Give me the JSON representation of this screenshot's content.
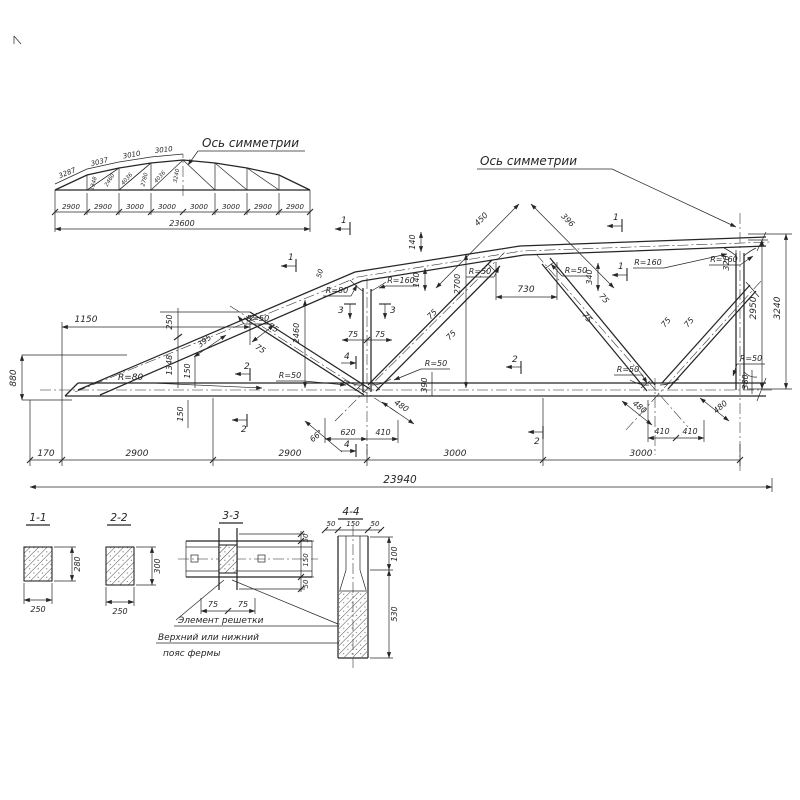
{
  "colors": {
    "ink": "#262626",
    "paper": "#ffffff"
  },
  "overview": {
    "axis_label": "Ось симметрии",
    "top_chord_dims": [
      "3287",
      "3037",
      "3010",
      "3010"
    ],
    "web_dims": [
      "1348",
      "2460",
      "4036",
      "2780",
      "4036",
      "3240"
    ],
    "panel_dims": [
      "2900",
      "2900",
      "3000",
      "3000",
      "3000",
      "3000",
      "2900",
      "2900"
    ],
    "total_span": "23600"
  },
  "elevation": {
    "axis_label": "Ось симметрии",
    "dims": {
      "d1150": "1150",
      "d880": "880",
      "d170": "170",
      "d2900": "2900",
      "d3000": "3000",
      "total": "23940",
      "d250": "250",
      "d1348": "1348",
      "d150": "150",
      "d395": "395",
      "d2460": "2460",
      "d50": "50",
      "d140": "140",
      "d2700": "2700",
      "d730": "730",
      "d450": "450",
      "d396": "396",
      "d340": "340",
      "d320": "320",
      "d2950": "2950",
      "d3240": "3240",
      "d390": "390",
      "d380": "380",
      "d620": "620",
      "d410": "410",
      "d480": "480",
      "d66": "66°",
      "d75": "75"
    },
    "radii": {
      "r50": "R=50",
      "r80": "R=80",
      "r160": "R=160"
    },
    "marks": {
      "s1": "1",
      "s2": "2",
      "s3": "3",
      "s4": "4"
    }
  },
  "sections": {
    "s11": {
      "title": "1-1",
      "w": "250",
      "h": "280"
    },
    "s22": {
      "title": "2-2",
      "w": "250",
      "h": "300"
    },
    "s33": {
      "title": "3-3",
      "d50": "50",
      "d150": "150",
      "d75": "75"
    },
    "s44": {
      "title": "4-4",
      "d50": "50",
      "d150": "150",
      "d100": "100",
      "d530": "530"
    },
    "callouts": {
      "lattice": "Элемент решетки",
      "chord_line1": "Верхний или нижний",
      "chord_line2": "пояс фермы"
    }
  }
}
